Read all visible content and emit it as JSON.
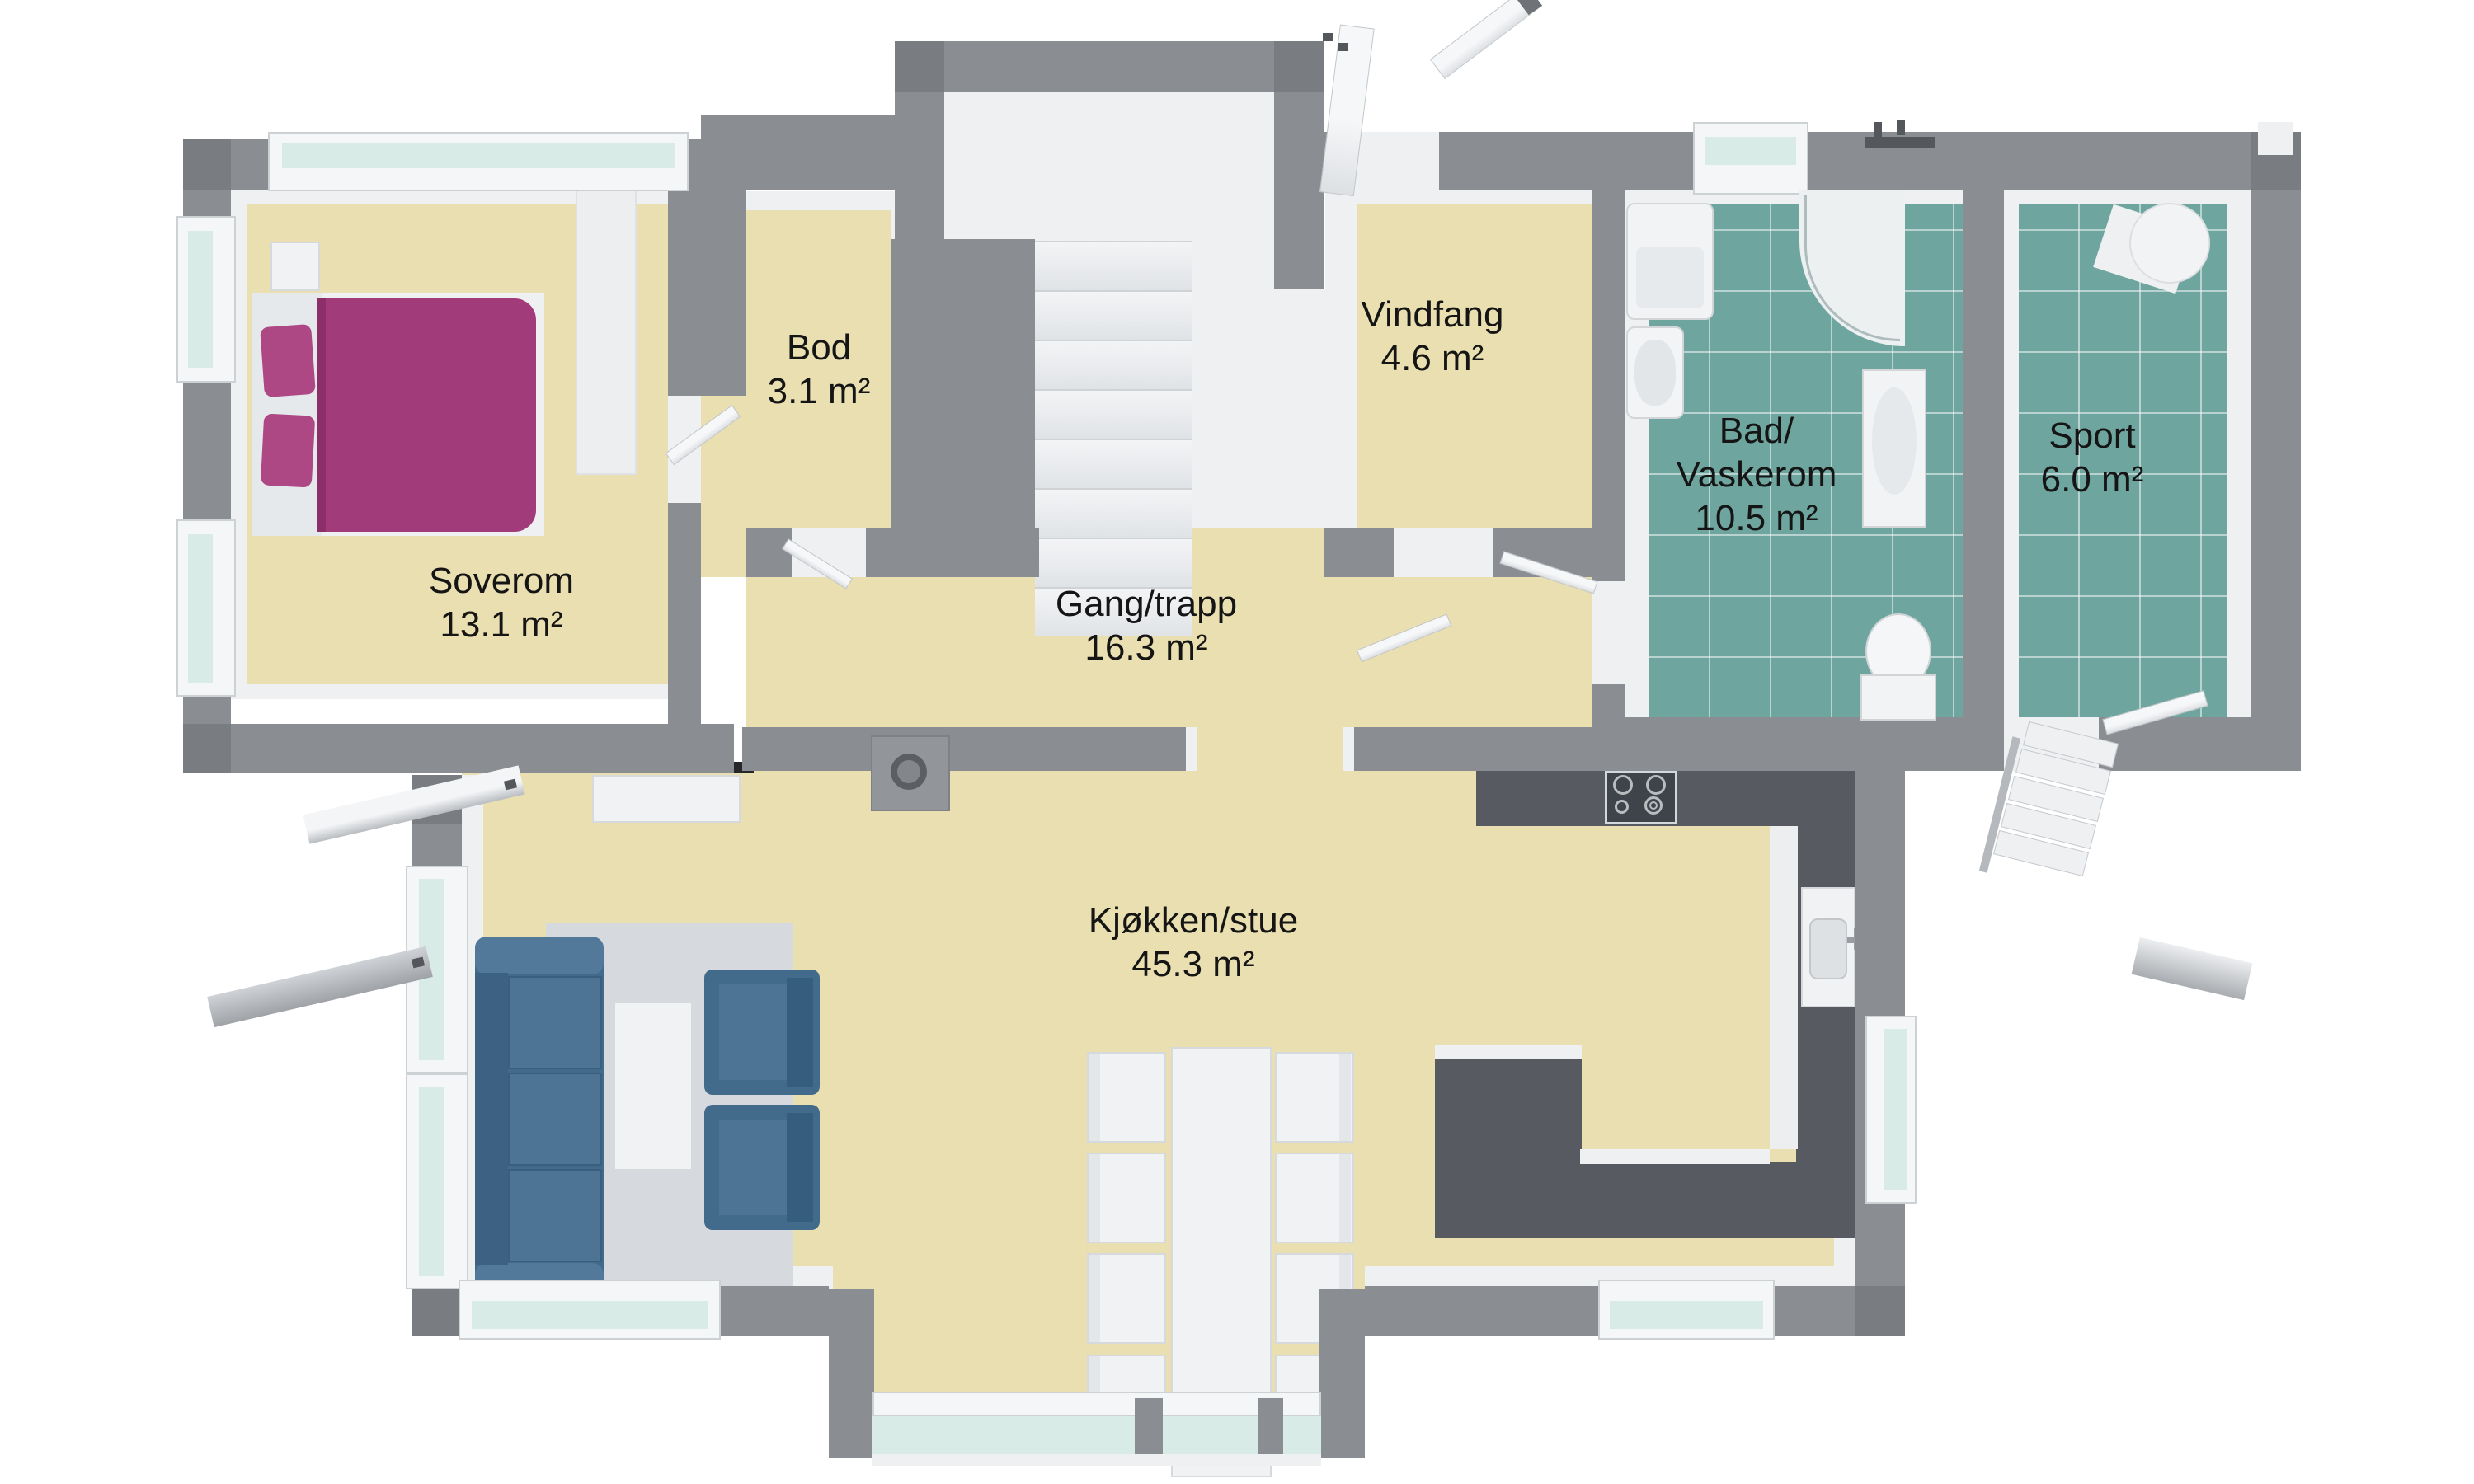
{
  "title": "First floor plan (Norwegian house)",
  "rooms": [
    {
      "id": "soverom",
      "name": "Soverom",
      "area": "13.1 m²"
    },
    {
      "id": "bod",
      "name": "Bod",
      "area": "3.1 m²"
    },
    {
      "id": "vindfang",
      "name": "Vindfang",
      "area": "4.6 m²"
    },
    {
      "id": "bad_vaskerom",
      "name": "Bad/",
      "name2": "Vaskerom",
      "area": "10.5 m²"
    },
    {
      "id": "sport",
      "name": "Sport",
      "area": "6.0 m²"
    },
    {
      "id": "gang_trapp",
      "name": "Gang/trapp",
      "area": "16.3 m²"
    },
    {
      "id": "kjokken_stue",
      "name": "Kjøkken/stue",
      "area": "45.3 m²"
    }
  ],
  "colors": {
    "wall_grey": "#8a8e92",
    "wall_dark": "#797c80",
    "floor_beige": "#e9dfb0",
    "tile_teal": "#6fa59f",
    "inner_white": "#eef0f2",
    "window_glass": "#d8ebe7",
    "bed_magenta": "#a23b79",
    "pillow_magenta": "#ad4884",
    "sofa_blue": "#426a8b",
    "counter_dark": "#575b61",
    "label_text": "#151515"
  }
}
